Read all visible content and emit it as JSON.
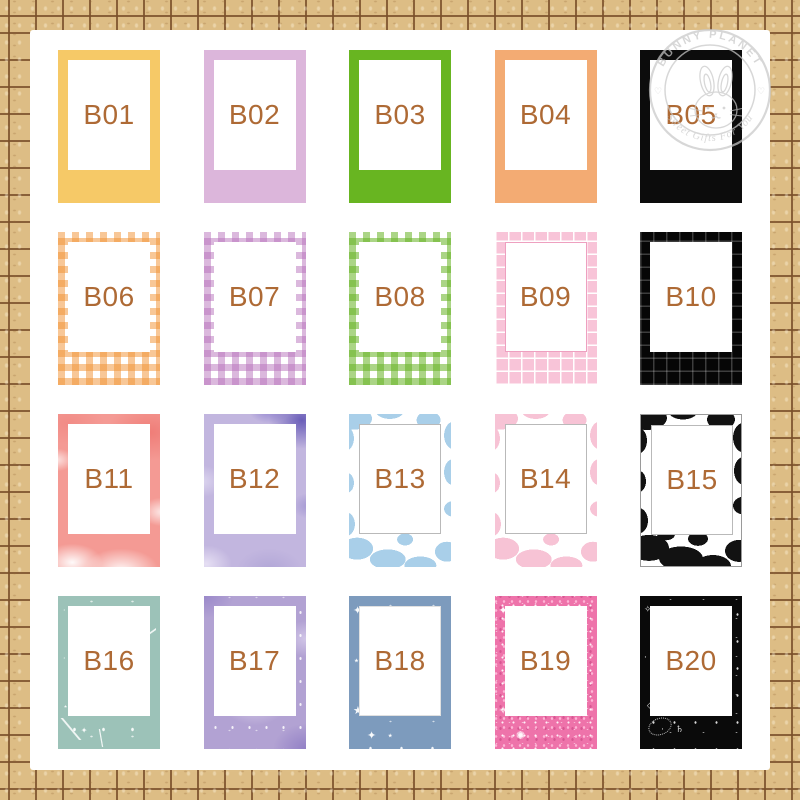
{
  "page": {
    "background_color": "#ddbd85",
    "grid_line_color": "#7a502a",
    "panel_color": "#ffffff",
    "label_color": "#ae6a35"
  },
  "watermark": {
    "brand_top": "BUNNY PLANET",
    "brand_bottom": "Sweet Gifts For You",
    "left_symbol": "♡",
    "right_symbol": "♡",
    "icon": "bunny-face-icon",
    "color": "#c9c9c9"
  },
  "frames": [
    {
      "id": "B01",
      "pattern": "solid-yellow",
      "color": "#f6c967"
    },
    {
      "id": "B02",
      "pattern": "solid-lilac",
      "color": "#dcb6db"
    },
    {
      "id": "B03",
      "pattern": "solid-green",
      "color": "#68b521"
    },
    {
      "id": "B04",
      "pattern": "solid-peach",
      "color": "#f3ab73"
    },
    {
      "id": "B05",
      "pattern": "solid-black",
      "color": "#0c0c0c"
    },
    {
      "id": "B06",
      "pattern": "gingham-orange",
      "color": "#f09030"
    },
    {
      "id": "B07",
      "pattern": "gingham-purple",
      "color": "#b771bb"
    },
    {
      "id": "B08",
      "pattern": "gingham-green",
      "color": "#66b223"
    },
    {
      "id": "B09",
      "pattern": "grid-pink",
      "color": "#f8c4d8"
    },
    {
      "id": "B10",
      "pattern": "grid-black",
      "color": "#060606"
    },
    {
      "id": "B11",
      "pattern": "clouds-pink",
      "color": "#f49a94"
    },
    {
      "id": "B12",
      "pattern": "clouds-purple",
      "color": "#c2b6df"
    },
    {
      "id": "B13",
      "pattern": "cow-blue",
      "color": "#a9cfe9"
    },
    {
      "id": "B14",
      "pattern": "cow-pink",
      "color": "#f7c3d5"
    },
    {
      "id": "B15",
      "pattern": "cow-black",
      "color": "#121212"
    },
    {
      "id": "B16",
      "pattern": "constellation-teal",
      "color": "#9cc2b8"
    },
    {
      "id": "B17",
      "pattern": "galaxy-purple",
      "color": "#b2a2d3"
    },
    {
      "id": "B18",
      "pattern": "stars-blue",
      "color": "#7d9bbd"
    },
    {
      "id": "B19",
      "pattern": "glitter-pink",
      "color": "#ee73aa"
    },
    {
      "id": "B20",
      "pattern": "constellation-black",
      "color": "#0a0a0a"
    }
  ]
}
